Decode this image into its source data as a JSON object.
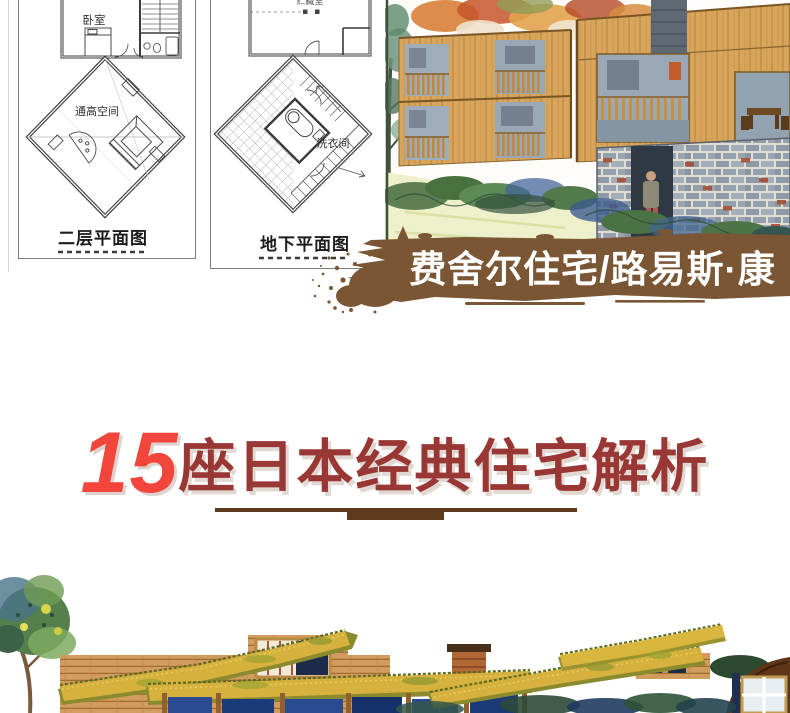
{
  "plans": {
    "upper": {
      "bedroom": "卧室",
      "void": "通高空间",
      "caption": "二层平面图"
    },
    "lower": {
      "storage": "贮藏室",
      "laundry": "洗衣间",
      "caption": "地下平面图"
    }
  },
  "banner": {
    "label": "费舍尔住宅/路易斯·康"
  },
  "headline": {
    "number": "15",
    "suffix": "座日本经典住宅解析"
  },
  "colors": {
    "banner_brown": "#7b5634",
    "headline_number_red": "#f2453c",
    "headline_text_red": "#993734",
    "underline_brown": "#5e3a1d"
  }
}
